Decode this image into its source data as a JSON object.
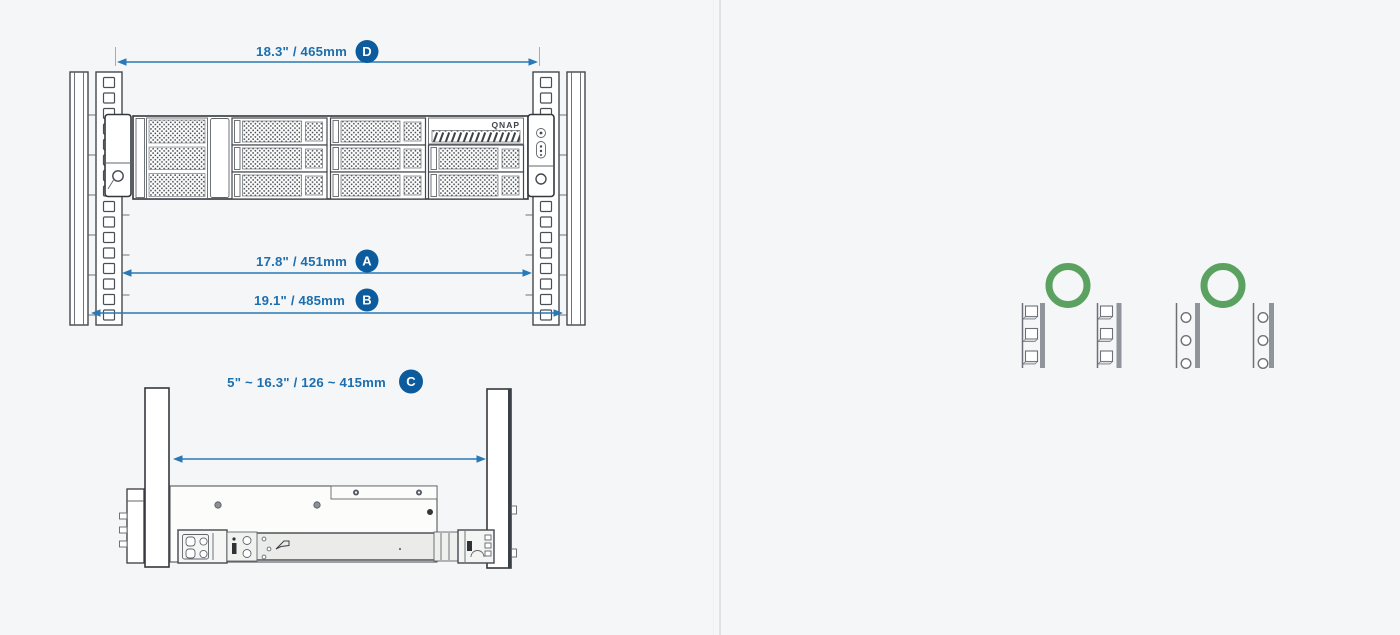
{
  "canvas": {
    "width": 1400,
    "height": 635
  },
  "colors": {
    "background": "#f5f6f8",
    "divider": "#e0e2e6",
    "dimension_text": "#1c6fae",
    "badge_fill": "#0b5b9d",
    "badge_text": "#ffffff",
    "arrow": "#2979b5",
    "outline": "#44484e",
    "green_ring": "#5ba261"
  },
  "front_view": {
    "name": "rack-front-view-with-nas",
    "brand": "QNAP",
    "dimensions": [
      {
        "id": "D",
        "label": "18.3\" / 465mm"
      },
      {
        "id": "A",
        "label": "17.8\" / 451mm"
      },
      {
        "id": "B",
        "label": "19.1\" / 485mm"
      }
    ]
  },
  "side_view": {
    "name": "rail-side-view-between-posts",
    "dimension": {
      "id": "C",
      "label": "5\" ~ 16.3\" / 126 ~ 415mm"
    }
  },
  "rack_compatibility": {
    "items": [
      {
        "type": "square-hole-rack-posts",
        "marker": "green-ring"
      },
      {
        "type": "round-hole-rack-posts",
        "marker": "green-ring"
      }
    ]
  }
}
